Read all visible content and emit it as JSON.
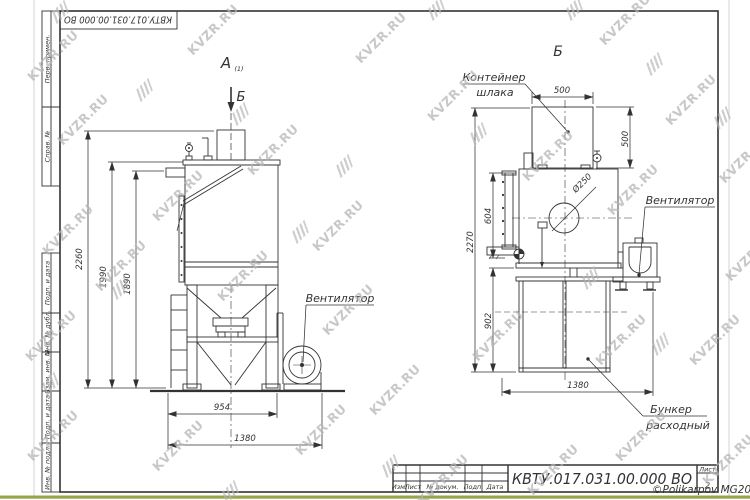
{
  "frame": {
    "stamp": "КВТУ.017.031.00.000 ВО",
    "margin_labels": [
      "Перв. примен.",
      "Справ. №",
      "Подп. и дата",
      "Инв. № дубл.",
      "Взам. инв. №",
      "Подп. и дата",
      "Инв. № подл."
    ]
  },
  "view_a": {
    "title": "А",
    "title_sub": "(1)",
    "section_label": "Б",
    "fan_label": "Вентилятор",
    "dim_2260": "2260",
    "dim_1990": "1990",
    "dim_1890": "1890",
    "dim_954": "954",
    "dim_1380": "1380"
  },
  "view_b": {
    "title": "Б",
    "container_line1": "Контейнер",
    "container_line2": "шлака",
    "fan_label": "Вентилятор",
    "hopper_line1": "Бункер",
    "hopper_line2": "расходный",
    "dim_500_w": "500",
    "dim_500_h": "500",
    "dim_604": "604",
    "dim_2270": "2270",
    "dim_902": "902",
    "dim_1380": "1380",
    "dim_hole": "Ø250"
  },
  "title_block": {
    "col_izm": "Изм.",
    "col_list": "Лист",
    "col_doc": "№ докум.",
    "col_sign": "Подп.",
    "col_date": "Дата",
    "code": "КВТУ.017.031.00.000 ВО",
    "sheet_label": "Лист",
    "sheet_value": "2"
  },
  "watermark": {
    "text": "KVZR.RU",
    "copyright": "©Polikarpov MG2021"
  }
}
